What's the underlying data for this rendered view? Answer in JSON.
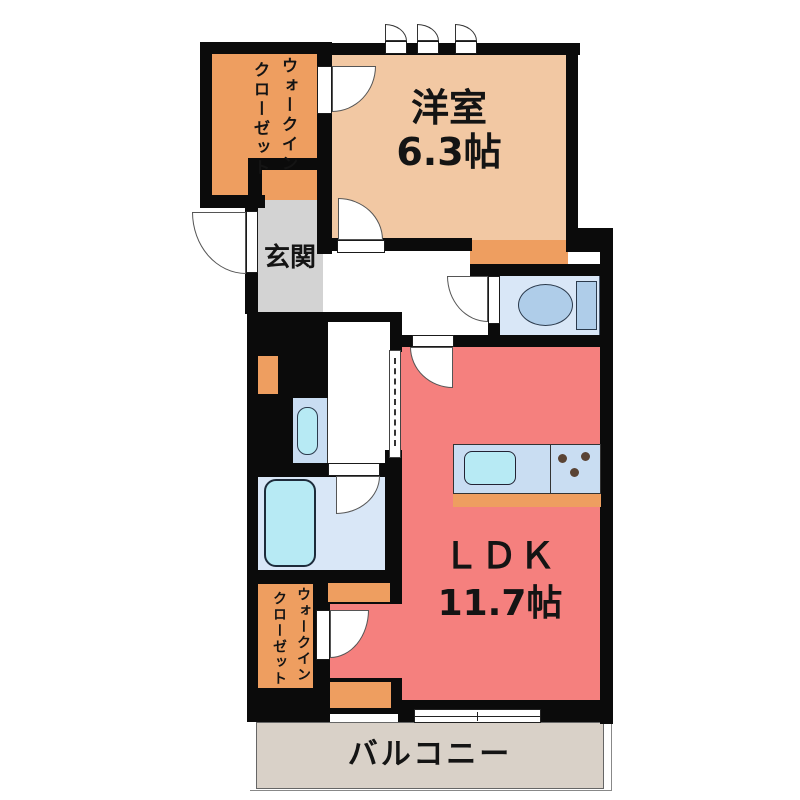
{
  "plan": {
    "rooms": {
      "walk_in_closet_top": {
        "label_col1": "ウォークイン",
        "label_col2": "クローゼット"
      },
      "western_room": {
        "name": "洋室",
        "size": "6.3帖"
      },
      "entrance": {
        "name": "玄関"
      },
      "ldk": {
        "name": "ＬＤＫ",
        "size": "11.7帖"
      },
      "walk_in_closet_bottom": {
        "label_col1": "ウォークイン",
        "label_col2": "クローゼット"
      },
      "balcony": {
        "name": "バルコニー"
      }
    },
    "colors": {
      "wall": "#0b0b0b",
      "closet_orange": "#EE9E60",
      "western_room_peach": "#F2C8A3",
      "entrance_gray": "#D3D3D3",
      "ldk_red": "#F5807E",
      "wet_area_blue": "#D9E7F7",
      "counter_blue": "#C9DDF2",
      "fixture_cyan": "#B7EAF4",
      "balcony_beige": "#D9D1C8"
    },
    "fixture_icons": [
      "toilet-icon",
      "bathtub-icon",
      "washbasin-icon",
      "kitchen-sink-icon",
      "stove-burners-icon",
      "door-swing-icon",
      "sliding-door-icon",
      "window-icon"
    ]
  }
}
